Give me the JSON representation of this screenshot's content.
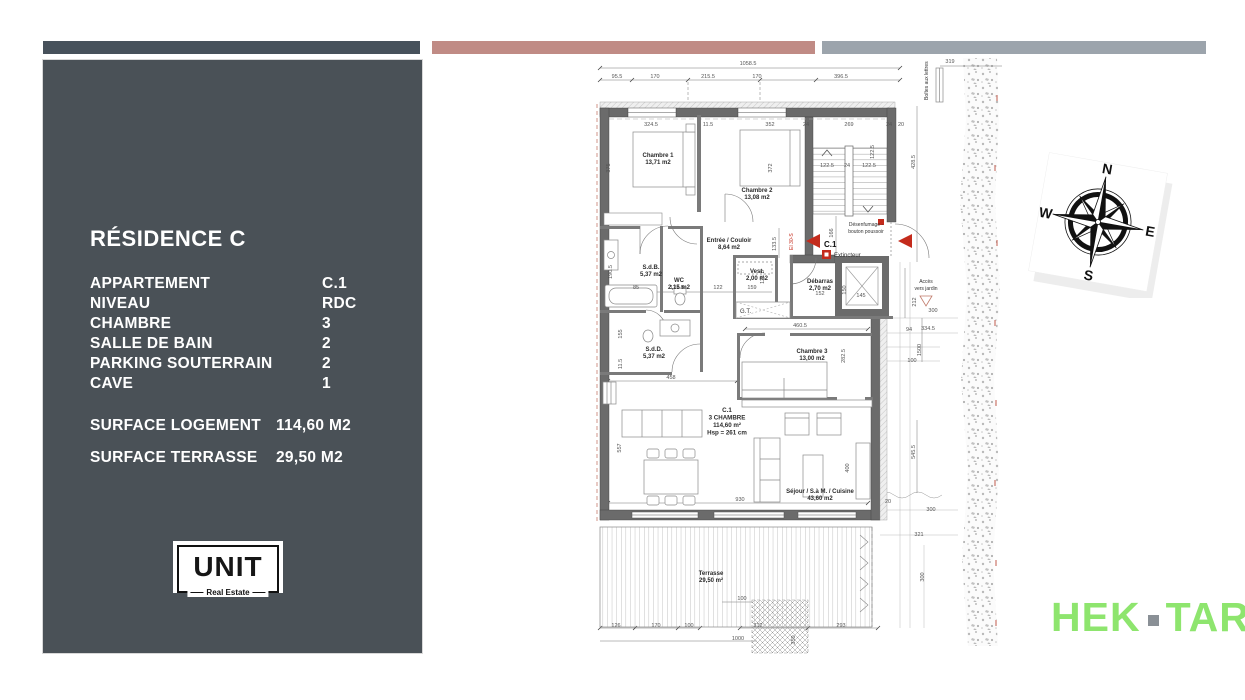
{
  "colors": {
    "bar_left": "#47515B",
    "bar_mid": "#C08B85",
    "bar_right": "#9CA4AC",
    "panel_bg": "#4A5157",
    "wall": "#6B6B6B",
    "accent_red": "#C42B1C",
    "brand_green": "#8EE56E",
    "brand_dot_gray": "#8A9096"
  },
  "sidebar": {
    "title": "RÉSIDENCE C",
    "specs": [
      {
        "label": "APPARTEMENT",
        "value": "C.1"
      },
      {
        "label": "NIVEAU",
        "value": "RDC"
      },
      {
        "label": "CHAMBRE",
        "value": "3"
      },
      {
        "label": "SALLE DE BAIN",
        "value": "2"
      },
      {
        "label": "PARKING SOUTERRAIN",
        "value": "2"
      },
      {
        "label": "CAVE",
        "value": "1"
      }
    ],
    "surfaces": [
      {
        "label": "SURFACE LOGEMENT",
        "value": "114,60 M2"
      },
      {
        "label": "SURFACE TERRASSE",
        "value": "29,50 M2"
      }
    ],
    "logo": {
      "name": "UNIT",
      "tagline": "Real Estate"
    }
  },
  "plan": {
    "unit_block": {
      "lines": [
        "C.1",
        "3 CHAMBRE",
        "114,60 m²",
        "Hsp = 261 cm"
      ],
      "x": 727,
      "y": 412
    },
    "room_labels": [
      {
        "lines": [
          "Chambre 1",
          "13,71 m2"
        ],
        "x": 658,
        "y": 157
      },
      {
        "lines": [
          "Chambre 2",
          "13,08 m2"
        ],
        "x": 757,
        "y": 192
      },
      {
        "lines": [
          "Entrée / Couloir",
          "8,64 m2"
        ],
        "x": 729,
        "y": 242
      },
      {
        "lines": [
          "S.d.B.",
          "5,37 m2"
        ],
        "x": 651,
        "y": 269
      },
      {
        "lines": [
          "WC",
          "2,15 m2"
        ],
        "x": 679,
        "y": 282
      },
      {
        "lines": [
          "Vest.",
          "2,00 m2"
        ],
        "x": 757,
        "y": 273
      },
      {
        "lines": [
          "Débarras",
          "2,70 m2"
        ],
        "x": 820,
        "y": 283
      },
      {
        "lines": [
          "S.d.D.",
          "5,37 m2"
        ],
        "x": 654,
        "y": 351
      },
      {
        "lines": [
          "Chambre 3",
          "13,00 m2"
        ],
        "x": 812,
        "y": 353
      },
      {
        "lines": [
          "Séjour / S.à M. / Cuisine",
          "43,60 m2"
        ],
        "x": 820,
        "y": 493
      },
      {
        "lines": [
          "Terrasse",
          "29,50 m²"
        ],
        "x": 711,
        "y": 575
      }
    ],
    "annotations": [
      {
        "t": "C.1",
        "x": 824,
        "y": 247,
        "cls": "marker"
      },
      {
        "t": "Extincteur",
        "x": 834,
        "y": 257,
        "cls": "small start"
      },
      {
        "lines": [
          "Désenfumage -",
          "bouton poussoir"
        ],
        "x": 866,
        "y": 226,
        "cls": "tiny"
      },
      {
        "lines": [
          "Accès",
          "vers jardin"
        ],
        "x": 926,
        "y": 283,
        "cls": "tiny"
      },
      {
        "t": "G.T.",
        "x": 740,
        "y": 313,
        "cls": "small start"
      },
      {
        "t": "Boîtes aux lettres",
        "x": 928,
        "y": 100,
        "r": -90,
        "cls": "tiny start"
      },
      {
        "t": "EI 30-S",
        "x": 793,
        "y": 250,
        "r": -90,
        "cls": "tiny red start"
      }
    ],
    "dims": [
      {
        "t": "1058.5",
        "x": 748,
        "y": 65
      },
      {
        "t": "95.5",
        "x": 617,
        "y": 78
      },
      {
        "t": "170",
        "x": 655,
        "y": 78
      },
      {
        "t": "215.5",
        "x": 708,
        "y": 78
      },
      {
        "t": "170",
        "x": 757,
        "y": 78
      },
      {
        "t": "396.5",
        "x": 841,
        "y": 78
      },
      {
        "t": "319",
        "x": 950,
        "y": 63
      },
      {
        "t": "324.5",
        "x": 651,
        "y": 126
      },
      {
        "t": "11.5",
        "x": 708,
        "y": 126
      },
      {
        "t": "352",
        "x": 770,
        "y": 126
      },
      {
        "t": "24",
        "x": 806,
        "y": 126
      },
      {
        "t": "269",
        "x": 849,
        "y": 126
      },
      {
        "t": "24",
        "x": 889,
        "y": 126
      },
      {
        "t": "20",
        "x": 901,
        "y": 126
      },
      {
        "t": "122.5",
        "x": 874,
        "y": 152,
        "r": -90
      },
      {
        "t": "428.5",
        "x": 915,
        "y": 162,
        "r": -90
      },
      {
        "t": "375",
        "x": 610,
        "y": 168,
        "r": -90
      },
      {
        "t": "372",
        "x": 772,
        "y": 168,
        "r": -90
      },
      {
        "t": "122.5",
        "x": 827,
        "y": 167
      },
      {
        "t": "24",
        "x": 847,
        "y": 167
      },
      {
        "t": "122.5",
        "x": 869,
        "y": 167
      },
      {
        "t": "166",
        "x": 833,
        "y": 233,
        "r": -90
      },
      {
        "t": "133.5",
        "x": 776,
        "y": 244,
        "r": -90
      },
      {
        "t": "190.5",
        "x": 612,
        "y": 272,
        "r": -90
      },
      {
        "t": "85",
        "x": 636,
        "y": 289
      },
      {
        "t": "127.5",
        "x": 677,
        "y": 289
      },
      {
        "t": "122",
        "x": 718,
        "y": 289
      },
      {
        "t": "159",
        "x": 752,
        "y": 289
      },
      {
        "t": "121.5",
        "x": 764,
        "y": 277,
        "r": -90
      },
      {
        "t": "152",
        "x": 820,
        "y": 295
      },
      {
        "t": "150",
        "x": 846,
        "y": 290,
        "r": -90
      },
      {
        "t": "145",
        "x": 861,
        "y": 297
      },
      {
        "t": "155",
        "x": 622,
        "y": 334,
        "r": -90
      },
      {
        "t": "11.5",
        "x": 622,
        "y": 364,
        "r": -90
      },
      {
        "t": "458",
        "x": 671,
        "y": 379
      },
      {
        "t": "460.5",
        "x": 800,
        "y": 327
      },
      {
        "t": "282.5",
        "x": 845,
        "y": 356,
        "r": -90
      },
      {
        "t": "557",
        "x": 621,
        "y": 448,
        "r": -90
      },
      {
        "t": "400",
        "x": 849,
        "y": 468,
        "r": -90
      },
      {
        "t": "930",
        "x": 740,
        "y": 501
      },
      {
        "t": "212",
        "x": 916,
        "y": 302,
        "r": -90
      },
      {
        "t": "300",
        "x": 933,
        "y": 312
      },
      {
        "t": "94",
        "x": 909,
        "y": 331
      },
      {
        "t": "334.5",
        "x": 928,
        "y": 330
      },
      {
        "t": "1500",
        "x": 921,
        "y": 350,
        "r": -90
      },
      {
        "t": "100",
        "x": 912,
        "y": 362
      },
      {
        "t": "545.5",
        "x": 915,
        "y": 452,
        "r": -90
      },
      {
        "t": "20",
        "x": 888,
        "y": 503
      },
      {
        "t": "300",
        "x": 931,
        "y": 511
      },
      {
        "t": "321",
        "x": 919,
        "y": 536
      },
      {
        "t": "300",
        "x": 924,
        "y": 577,
        "r": -90
      },
      {
        "t": "126",
        "x": 616,
        "y": 627
      },
      {
        "t": "170",
        "x": 656,
        "y": 627
      },
      {
        "t": "100",
        "x": 689,
        "y": 627
      },
      {
        "t": "312",
        "x": 758,
        "y": 627
      },
      {
        "t": "293",
        "x": 841,
        "y": 627
      },
      {
        "t": "100",
        "x": 742,
        "y": 600
      },
      {
        "t": "350",
        "x": 795,
        "y": 640,
        "r": -90
      },
      {
        "t": "1000",
        "x": 738,
        "y": 640
      }
    ]
  },
  "compass": {
    "n": "N",
    "e": "E",
    "s": "S",
    "w": "W"
  },
  "brand": {
    "left": "HEK",
    "right": "TAR"
  }
}
